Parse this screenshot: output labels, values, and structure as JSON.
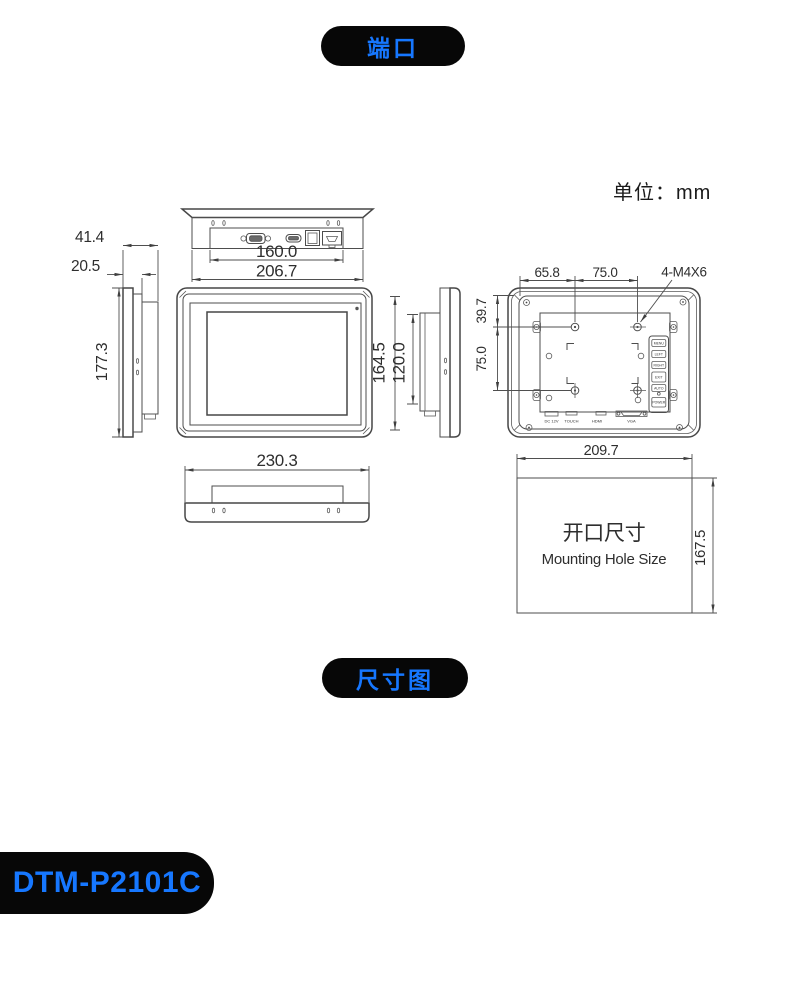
{
  "badges": {
    "ports": "端口",
    "dimensions": "尺寸图",
    "model": "DTM-P2101C"
  },
  "unit_label": "单位：mm",
  "top_view": {
    "dim_port_width": "160.0",
    "dim_body_width": "206.7"
  },
  "side_view_left": {
    "dim_total_depth": "41.4",
    "dim_front_depth": "20.5",
    "dim_height": "177.3"
  },
  "front_view": {
    "dim_body_height": "164.5",
    "dim_screen_height": "120.0"
  },
  "rear_view": {
    "dim_hole_offset_x": "65.8",
    "dim_hole_pitch_x": "75.0",
    "screw_spec": "4-M4X6",
    "dim_hole_offset_y": "39.7",
    "dim_hole_pitch_y": "75.0",
    "connector_labels": [
      "DC 12V",
      "TOUCH",
      "HDMI",
      "VGA"
    ],
    "osd_buttons": [
      "MENU",
      "LEFT",
      "RIGHT",
      "EXIT",
      "AUTO",
      "POWER"
    ]
  },
  "bottom_view": {
    "dim_bezel_width": "230.3"
  },
  "cutout": {
    "dim_width": "209.7",
    "dim_height": "167.5",
    "title_cn": "开口尺寸",
    "title_en": "Mounting Hole Size"
  }
}
